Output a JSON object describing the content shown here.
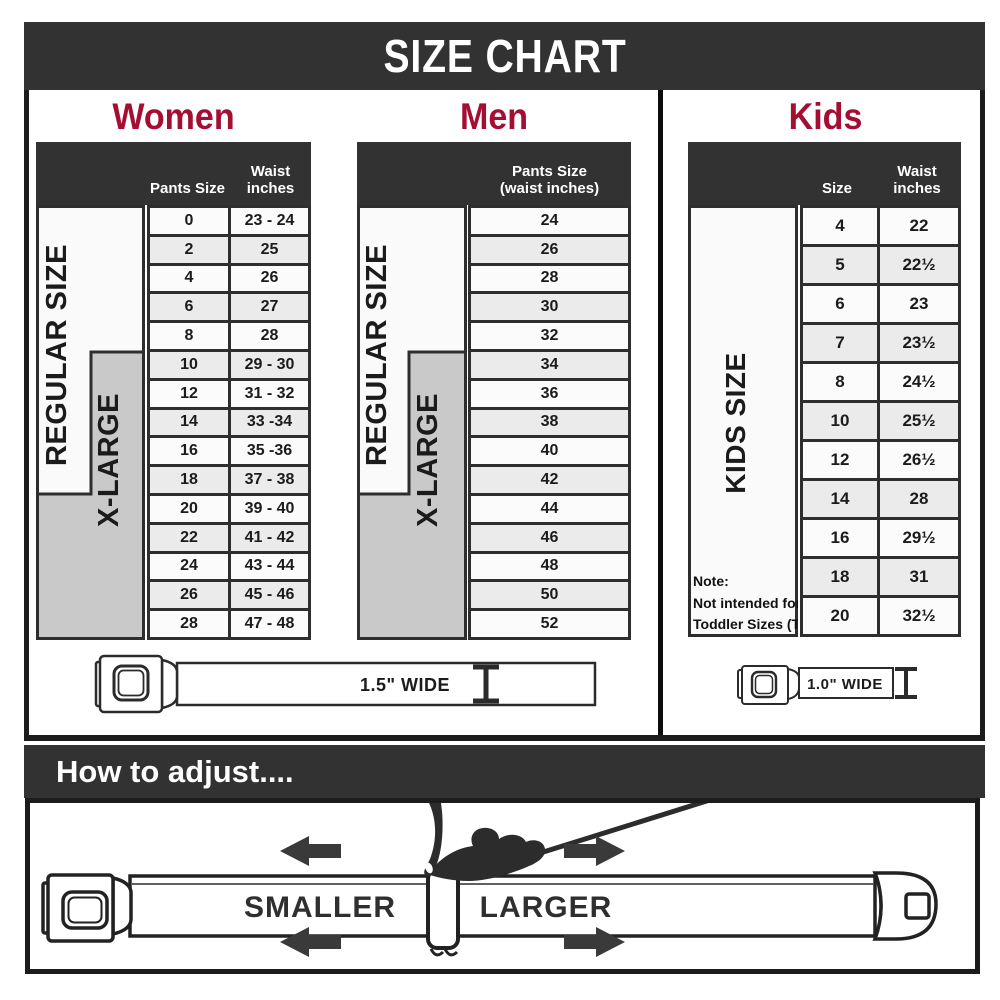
{
  "title": "SIZE CHART",
  "colors": {
    "accent": "#a40e33",
    "dark": "#323232",
    "row_alt": "#ebebeb",
    "xlarge_gray": "#c9c9c9"
  },
  "women": {
    "title": "Women",
    "header": {
      "pants": "Pants Size",
      "waist_line1": "Waist",
      "waist_line2": "inches"
    },
    "regular_label": "REGULAR SIZE",
    "xlarge_label": "X-LARGE",
    "rows": [
      {
        "size": "0",
        "waist": "23 - 24"
      },
      {
        "size": "2",
        "waist": "25"
      },
      {
        "size": "4",
        "waist": "26"
      },
      {
        "size": "6",
        "waist": "27"
      },
      {
        "size": "8",
        "waist": "28"
      },
      {
        "size": "10",
        "waist": "29 - 30"
      },
      {
        "size": "12",
        "waist": "31 - 32"
      },
      {
        "size": "14",
        "waist": "33 -34"
      },
      {
        "size": "16",
        "waist": "35 -36"
      },
      {
        "size": "18",
        "waist": "37 - 38"
      },
      {
        "size": "20",
        "waist": "39 - 40"
      },
      {
        "size": "22",
        "waist": "41 - 42"
      },
      {
        "size": "24",
        "waist": "43 - 44"
      },
      {
        "size": "26",
        "waist": "45 - 46"
      },
      {
        "size": "28",
        "waist": "47 - 48"
      }
    ]
  },
  "men": {
    "title": "Men",
    "header": {
      "line1": "Pants Size",
      "line2": "(waist inches)"
    },
    "regular_label": "REGULAR SIZE",
    "xlarge_label": "X-LARGE",
    "rows": [
      "24",
      "26",
      "28",
      "30",
      "32",
      "34",
      "36",
      "38",
      "40",
      "42",
      "44",
      "46",
      "48",
      "50",
      "52"
    ]
  },
  "kids": {
    "title": "Kids",
    "header": {
      "size": "Size",
      "waist_line1": "Waist",
      "waist_line2": "inches"
    },
    "side_label": "KIDS SIZE",
    "note": {
      "line1": "Note:",
      "line2": "Not intended for",
      "line3": "Toddler Sizes (T)"
    },
    "rows": [
      {
        "size": "4",
        "waist": "22"
      },
      {
        "size": "5",
        "waist": "22½"
      },
      {
        "size": "6",
        "waist": "23"
      },
      {
        "size": "7",
        "waist": "23½"
      },
      {
        "size": "8",
        "waist": "24½"
      },
      {
        "size": "10",
        "waist": "25½"
      },
      {
        "size": "12",
        "waist": "26½"
      },
      {
        "size": "14",
        "waist": "28"
      },
      {
        "size": "16",
        "waist": "29½"
      },
      {
        "size": "18",
        "waist": "31"
      },
      {
        "size": "20",
        "waist": "32½"
      }
    ]
  },
  "belts": {
    "adult_width": "1.5\" WIDE",
    "kids_width": "1.0\" WIDE"
  },
  "adjust": {
    "heading": "How to adjust....",
    "smaller": "SMALLER",
    "larger": "LARGER"
  }
}
